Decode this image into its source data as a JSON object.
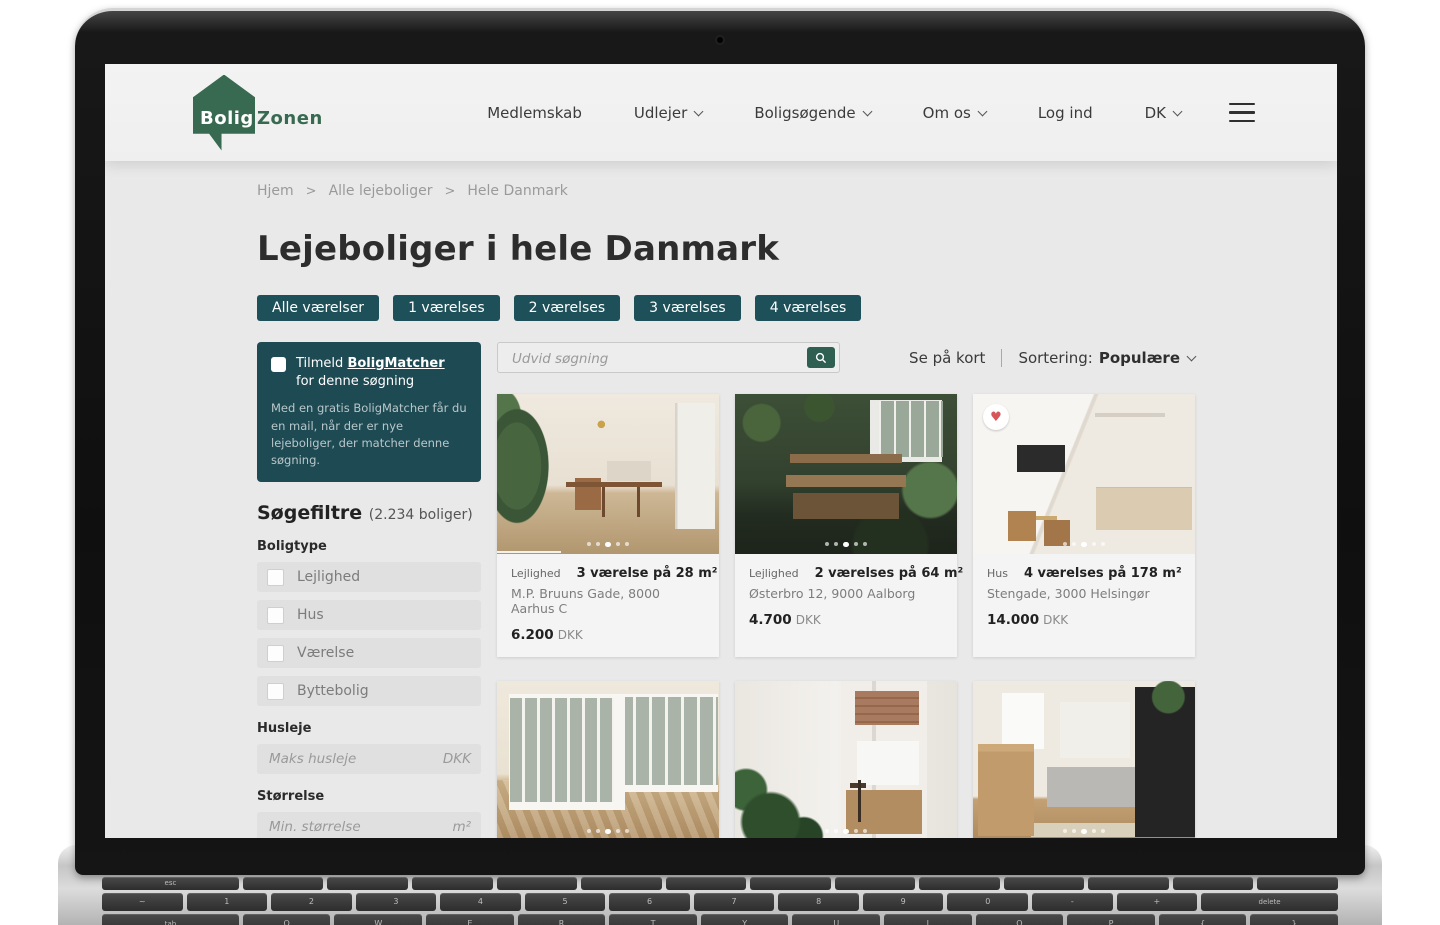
{
  "colors": {
    "accent_teal": "#1d5058",
    "matcher_box_teal": "#1e4a53",
    "logo_green": "#376a50",
    "search_button_green": "#2e5f50",
    "heart_red": "#d6565a"
  },
  "logo": {
    "bolig": "Bolig",
    "zonen": "Zonen"
  },
  "nav": {
    "items": [
      {
        "label": "Medlemskab",
        "dropdown": false
      },
      {
        "label": "Udlejer",
        "dropdown": true
      },
      {
        "label": "Boligsøgende",
        "dropdown": true
      },
      {
        "label": "Om os",
        "dropdown": true
      },
      {
        "label": "Log ind",
        "dropdown": false
      },
      {
        "label": "DK",
        "dropdown": true
      }
    ]
  },
  "breadcrumb": {
    "separator": ">",
    "items": [
      "Hjem",
      "Alle lejeboliger",
      "Hele Danmark"
    ]
  },
  "page": {
    "title": "Lejeboliger i hele Danmark"
  },
  "room_filters": [
    "Alle værelser",
    "1 værelses",
    "2 værelses",
    "3 værelses",
    "4 værelses"
  ],
  "matcher": {
    "prefix": "Tilmeld",
    "link": "BoligMatcher",
    "suffix": "for denne søgning",
    "description": "Med en gratis BoligMatcher får du en mail, når der er nye lejeboliger, der matcher denne søgning."
  },
  "filters": {
    "heading": "Søgefiltre",
    "count": "(2.234 boliger)",
    "boligtype_label": "Boligtype",
    "types": [
      "Lejlighed",
      "Hus",
      "Værelse",
      "Byttebolig"
    ],
    "husleje": {
      "label": "Husleje",
      "placeholder": "Maks husleje",
      "unit": "DKK"
    },
    "stoerrelse": {
      "label": "Størrelse",
      "placeholder": "Min. størrelse",
      "unit": "m²"
    },
    "antal_label": "Antal værelser"
  },
  "search": {
    "placeholder": "Udvid søgning"
  },
  "sort": {
    "map_link": "Se på kort",
    "label": "Sortering:",
    "value": "Populære"
  },
  "cards": [
    {
      "type": "Lejlighed",
      "title": "3 værelse på 28 m²",
      "address": "M.P. Bruuns Gade, 8000 Aarhus C",
      "price": "6.200",
      "currency": "DKK"
    },
    {
      "type": "Lejlighed",
      "title": "2 værelses på 64 m²",
      "address": "Østerbro 12, 9000 Aalborg",
      "price": "4.700",
      "currency": "DKK"
    },
    {
      "type": "Hus",
      "title": "4 værelses på 178 m²",
      "address": "Stengade, 3000 Helsingør",
      "price": "14.000",
      "currency": "DKK"
    },
    {
      "type": "Hus",
      "title": "3 værelses på 107 m²"
    },
    {
      "type": "Lejlighed",
      "title": "2 værelses på 56 m²"
    },
    {
      "type": "Lejlighed",
      "title": "3 værelses på 72 m²"
    }
  ],
  "keyboard": {
    "esc": "esc",
    "delete": "delete",
    "tab": "tab",
    "function_row": [
      "",
      "",
      "",
      "",
      "",
      "",
      "",
      "",
      "",
      "",
      "",
      "",
      ""
    ],
    "number_row": [
      "~",
      "1",
      "2",
      "3",
      "4",
      "5",
      "6",
      "7",
      "8",
      "9",
      "0",
      "-",
      "+"
    ],
    "letter_row": [
      "Q",
      "W",
      "E",
      "R",
      "T",
      "Y",
      "U",
      "I",
      "O",
      "P",
      "{",
      "}"
    ]
  }
}
